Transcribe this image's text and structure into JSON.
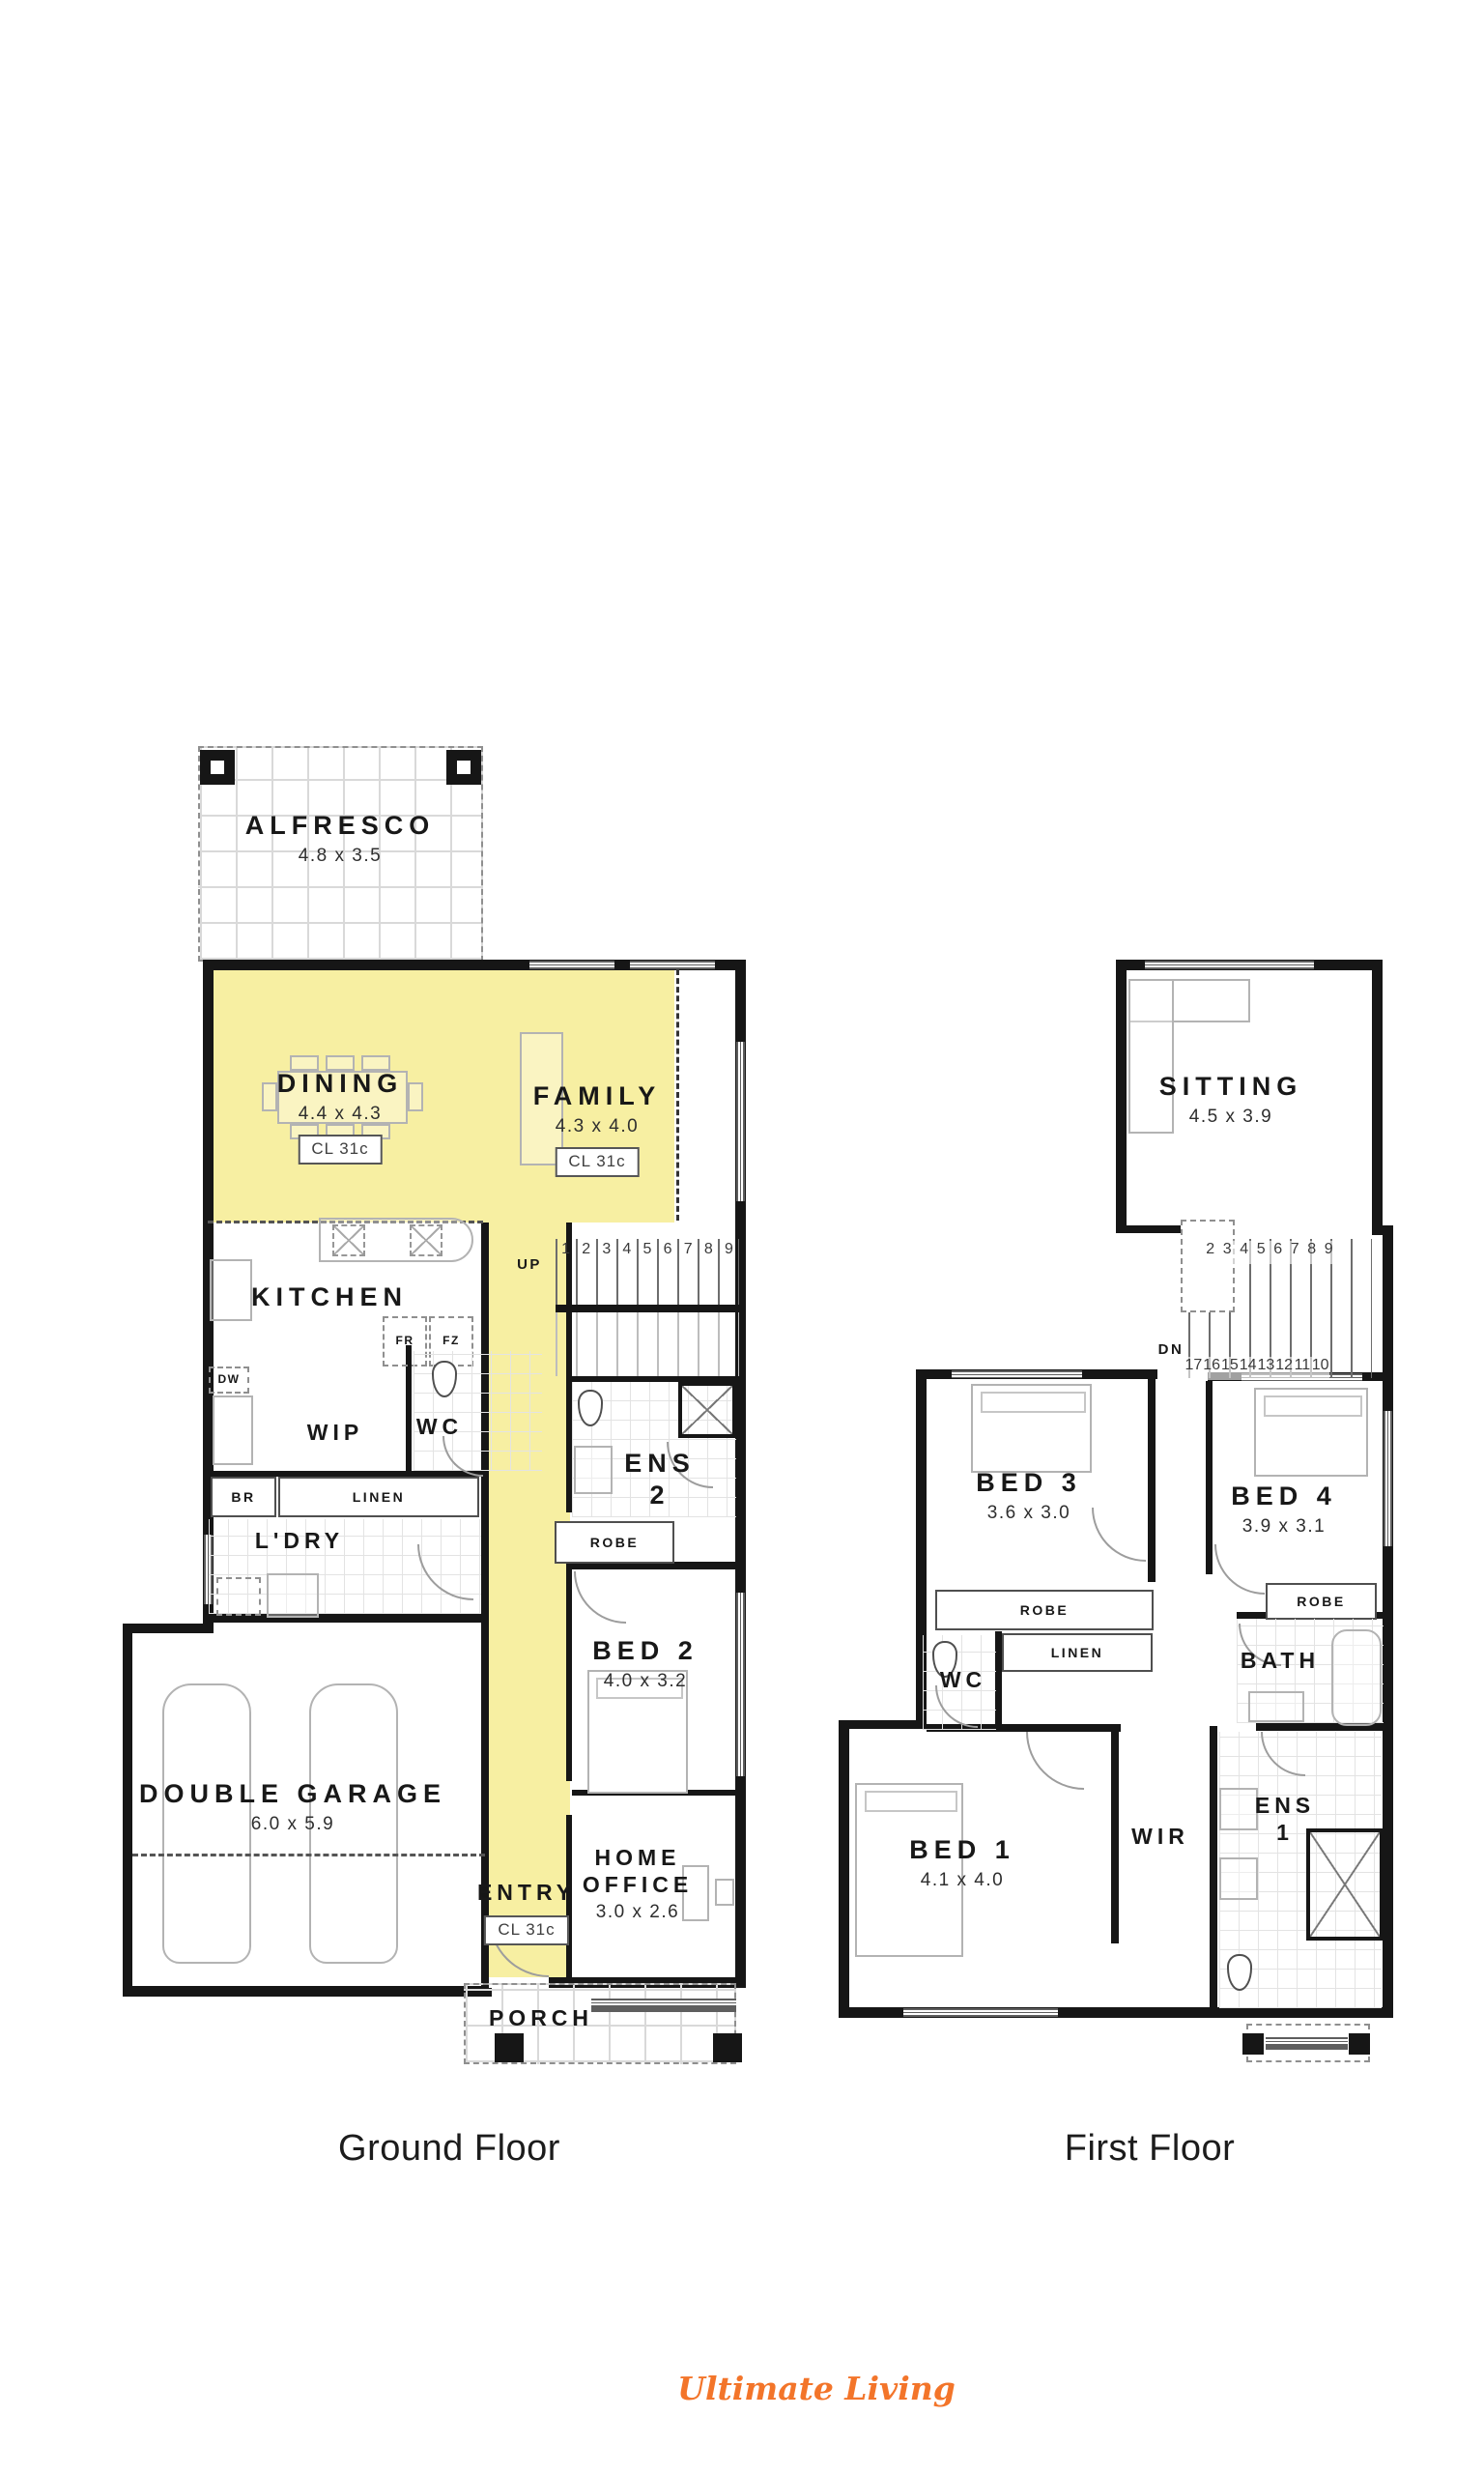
{
  "captions": {
    "ground": "Ground Floor",
    "first": "First Floor"
  },
  "brand": {
    "name": "Ultimate Living",
    "color": "#f3752a"
  },
  "colors": {
    "highlight": "#f7efa2",
    "wall": "#161616"
  },
  "ground_floor": {
    "alfresco_name": "ALFRESCO",
    "alfresco_dims": "4.8 x 3.5",
    "dining_name": "DINING",
    "dining_dims": "4.4 x 4.3",
    "dining_cl": "CL 31c",
    "family_name": "FAMILY",
    "family_dims": "4.3 x 4.0",
    "family_cl": "CL 31c",
    "kitchen_name": "KITCHEN",
    "fr": "FR",
    "fz": "FZ",
    "dw": "DW",
    "wip_name": "WIP",
    "wc_name": "WC",
    "br": "BR",
    "linen": "LINEN",
    "ldry_name": "L'DRY",
    "up": "UP",
    "steps": [
      "1",
      "2",
      "3",
      "4",
      "5",
      "6",
      "7",
      "8",
      "9"
    ],
    "ens2_line1": "ENS",
    "ens2_line2": "2",
    "robe": "ROBE",
    "bed2_name": "BED 2",
    "bed2_dims": "4.0 x 3.2",
    "garage_name": "DOUBLE GARAGE",
    "garage_dims": "6.0 x 5.9",
    "entry_name": "ENTRY",
    "entry_cl": "CL 31c",
    "office_line1": "HOME",
    "office_line2": "OFFICE",
    "office_dims": "3.0 x 2.6",
    "porch_name": "PORCH"
  },
  "first_floor": {
    "sitting_name": "SITTING",
    "sitting_dims": "4.5 x 3.9",
    "dn": "DN",
    "steps_top": [
      "2",
      "3",
      "4",
      "5",
      "6",
      "7",
      "8",
      "9"
    ],
    "steps_bottom": [
      "17",
      "16",
      "15",
      "14",
      "13",
      "12",
      "11",
      "10"
    ],
    "bed3_name": "BED 3",
    "bed3_dims": "3.6 x 3.0",
    "bed4_name": "BED 4",
    "bed4_dims": "3.9 x 3.1",
    "robe_bed3": "ROBE",
    "robe_bed4": "ROBE",
    "linen": "LINEN",
    "wc_name": "WC",
    "bath_name": "BATH",
    "bed1_name": "BED 1",
    "bed1_dims": "4.1 x 4.0",
    "wir_name": "WIR",
    "ens1_line1": "ENS",
    "ens1_line2": "1"
  }
}
